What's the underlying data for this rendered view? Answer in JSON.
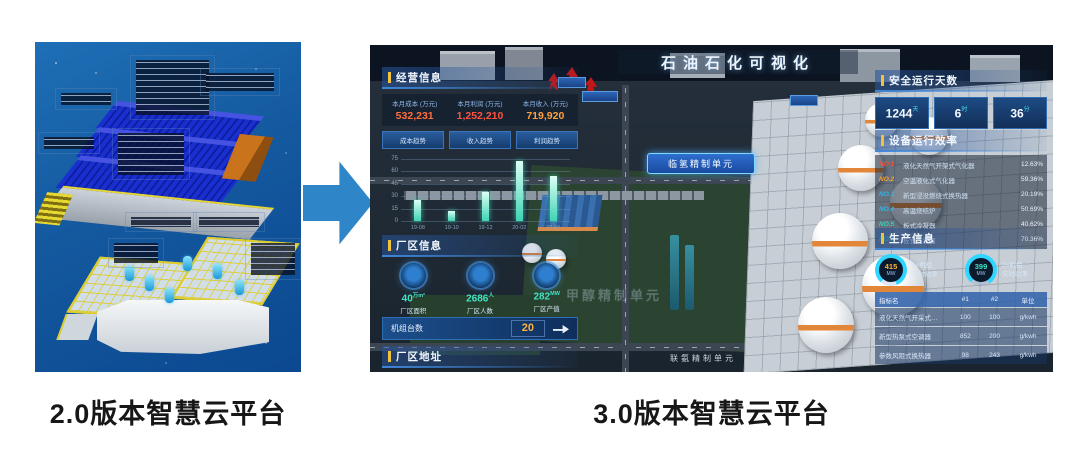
{
  "left_panel": {
    "caption": "2.0版本智慧云平台"
  },
  "right_caption": "3.0版本智慧云平台",
  "arrow": {
    "color": "#2e86c9"
  },
  "chart_data": {
    "type": "bar",
    "title": "",
    "xlabel": "",
    "ylabel": "",
    "categories": [
      "19-08",
      "19-10",
      "19-12",
      "20-02",
      "20-04"
    ],
    "values": [
      25,
      12,
      35,
      72,
      55
    ],
    "ylim": [
      0,
      75
    ],
    "yticks": [
      75,
      60,
      45,
      30,
      15,
      0
    ],
    "bar_color": "#3fd3b4",
    "grid": true,
    "legend_position": "none"
  },
  "dashboard": {
    "title": "石油石化可视化",
    "business": {
      "header": "经营信息",
      "metrics": [
        {
          "label": "本月成本 (万元)",
          "value": "532,231",
          "color": "#ff6e3c"
        },
        {
          "label": "本月利润 (万元)",
          "value": "1,252,210",
          "color": "#ff5340"
        },
        {
          "label": "本月收入 (万元)",
          "value": "719,920",
          "color": "#ffa13e"
        }
      ],
      "tabs": [
        "成本趋势",
        "收入趋势",
        "利润趋势"
      ]
    },
    "plant": {
      "header": "厂区信息",
      "stats": [
        {
          "value": "40",
          "unit": "万m²",
          "label": "厂区面积"
        },
        {
          "value": "2686",
          "unit": "人",
          "label": "厂区人数"
        },
        {
          "value": "282",
          "unit": "MW",
          "label": "厂区产值"
        }
      ],
      "units_row": {
        "label": "机组台数",
        "value": "20"
      }
    },
    "address_header": "厂区地址",
    "safety": {
      "header": "安全运行天数",
      "items": [
        {
          "value": "1244",
          "unit": "天"
        },
        {
          "value": "6",
          "unit": "时"
        },
        {
          "value": "36",
          "unit": "分"
        }
      ]
    },
    "efficiency": {
      "header": "设备运行效率",
      "rows": [
        {
          "no": "NO.1",
          "name": "液化天然气开架式气化器",
          "value": "12.63%",
          "color": "#ff5136"
        },
        {
          "no": "NO.2",
          "name": "空温液化式气化器",
          "value": "59.36%",
          "color": "#ffa22e"
        },
        {
          "no": "NO.3",
          "name": "新型浸没燃烧式换热器",
          "value": "20.19%",
          "color": "#2fb5e8"
        },
        {
          "no": "NO.4",
          "name": "高温烧结炉",
          "value": "50.69%",
          "color": "#2fb5e8"
        },
        {
          "no": "NO.5",
          "name": "板式冷凝器",
          "value": "40.62%",
          "color": "#35d3b8"
        },
        {
          "no": "NO.6",
          "name": "板式蒸发器",
          "value": "70.36%",
          "color": "#35d3b8"
        }
      ]
    },
    "production": {
      "header": "生产信息",
      "gauges": [
        {
          "value": "415",
          "unit": "MW",
          "label1": "1#机组",
          "label2": "实时功率",
          "value_color": "#ffb23e",
          "ring_color": "#2fd6ff"
        },
        {
          "value": "399",
          "unit": "MW",
          "label1": "2#机组",
          "label2": "实时功率",
          "value_color": "#43e2c3",
          "ring_color": "#2fd6ff"
        }
      ],
      "table": {
        "headers": [
          "指标名",
          "#1",
          "#2",
          "单位"
        ],
        "rows": [
          [
            "液化天然气开采式…",
            "100",
            "100",
            "g/kwh"
          ],
          [
            "新型热泵式空调器",
            "852",
            "200",
            "g/kwh"
          ],
          [
            "参数风阻式换热器",
            "98",
            "243",
            "g/kwh"
          ]
        ]
      }
    },
    "scene_labels": {
      "hydro_unit": "临氢精制单元",
      "hydrazine_unit": "联氨精制单元",
      "methanol_unit": "甲醇精制单元"
    }
  }
}
